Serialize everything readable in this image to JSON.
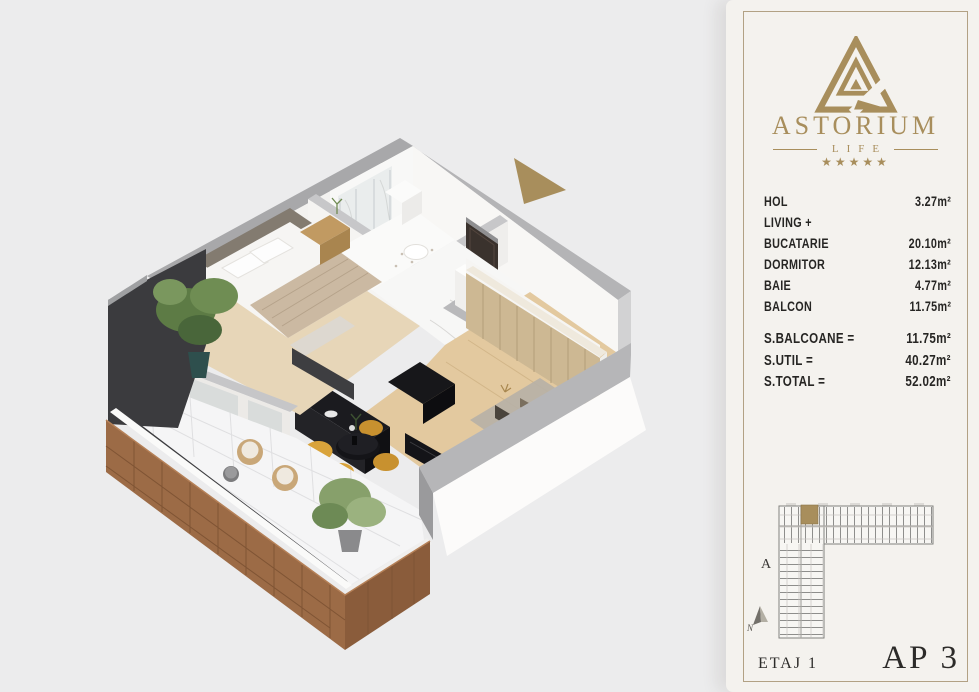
{
  "colors": {
    "bg": "#ececed",
    "card": "#f4f2ee",
    "border": "#b2a184",
    "gold": "#a88e5c",
    "ink": "#2e2d2b",
    "band": "#a8a8aa",
    "band2": "#b4b4b6",
    "wall": "#f8f7f5",
    "dark": "#3b3b3e",
    "black": "#141418",
    "wood": "#9c6b46",
    "woodshade": "#7f5434",
    "woodfloor": "#e3c99f",
    "wardrobe": "#cdb893",
    "bedfloor": "#e7d6b8",
    "tile": "#f5f5f6",
    "marble": "#fafaf9",
    "plant": "#5d7b45",
    "plant2": "#87a06b",
    "chair": "#d9a33b",
    "rug": "#b7b1a6",
    "pot": "#2e4f4d"
  },
  "sidebar": {
    "brand": {
      "name": "ASTORIUM",
      "tagline": "LIFE",
      "stars": "★★★★★"
    },
    "rooms": [
      {
        "name": "HOL",
        "area": "3.27m²"
      },
      {
        "name": "LIVING + BUCATARIE",
        "area": "20.10m²"
      },
      {
        "name": "DORMITOR",
        "area": "12.13m²"
      },
      {
        "name": "BAIE",
        "area": "4.77m²"
      },
      {
        "name": "BALCON",
        "area": "11.75m²"
      }
    ],
    "totals": [
      {
        "name": "S.BALCOANE =",
        "area": "11.75m²"
      },
      {
        "name": "S.UTIL =",
        "area": "40.27m²"
      },
      {
        "name": "S.TOTAL =",
        "area": "52.02m²"
      }
    ],
    "miniplan": {
      "building_label": "A",
      "compass_label": "N"
    },
    "footer": {
      "floor": "ETAJ 1",
      "apartment": "AP 3"
    }
  }
}
